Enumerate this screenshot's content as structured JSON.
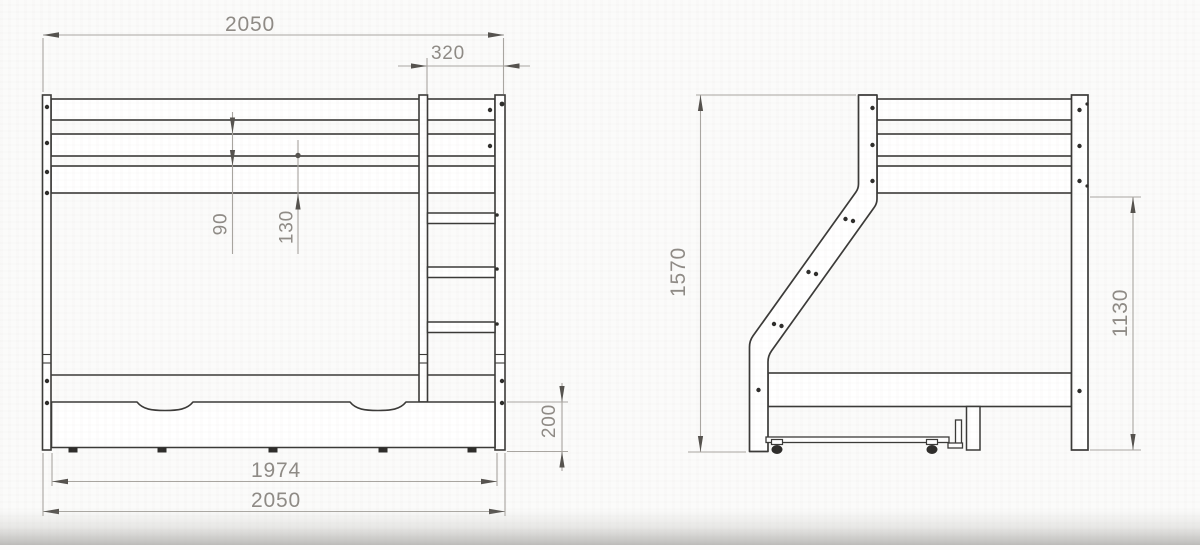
{
  "drawing": {
    "title": "bunk-bed-technical-drawing",
    "colors": {
      "geometry": "#3b3a38",
      "dimension_lines": "#a9a6a1",
      "dimension_text": "#8f8b86",
      "arrows": "#55524e",
      "background": "#fbfbfa"
    },
    "front_view": {
      "label": "front-view",
      "dimensions": {
        "overall_width_top": "2050",
        "ladder_width": "320",
        "guard_rail_gap": "90",
        "rail_gap": "130",
        "drawer_height": "200",
        "drawer_width": "1974",
        "overall_width_bottom": "2050"
      }
    },
    "side_view": {
      "label": "side-view",
      "dimensions": {
        "overall_height": "1570",
        "clearance_height": "1130"
      }
    }
  }
}
